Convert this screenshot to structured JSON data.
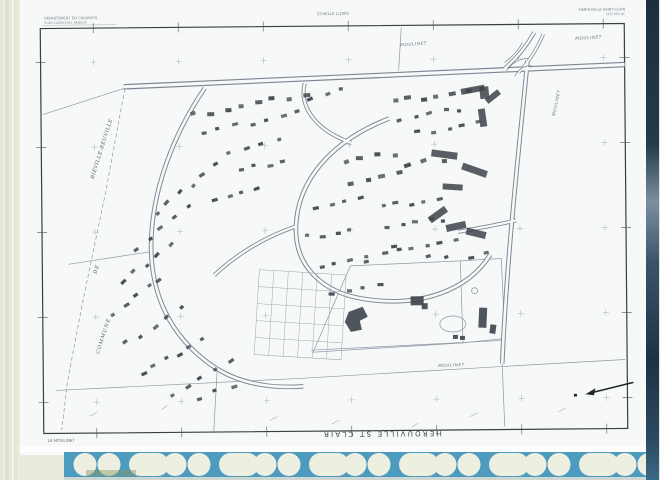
{
  "scan": {
    "film_strip_color": "#4d9cbf",
    "hole_color": "#edf0e1",
    "edge_band_color": "#e9ecdd",
    "paper_color": "#f6f9f8",
    "smudge_color": "#8a9460"
  },
  "header": {
    "left_line1": "DÉPARTEMENT DU CALVADOS",
    "left_line2": "PLAN CADASTRAL RÉNOVÉ",
    "center": "ÉCHELLE 1/2000",
    "right_line1": "HÉROUVILLE SAINT-CLAIR",
    "right_line2": "SECTION AC"
  },
  "labels": {
    "commune_word1": "COMMUNE",
    "commune_word2": "DE",
    "commune_word3": "BIÉVILLE-BEUVILLE",
    "places": [
      {
        "text": "MOULINET",
        "x": 402,
        "y": 47,
        "rot": -4
      },
      {
        "text": "MOULINET",
        "x": 577,
        "y": 42,
        "rot": -3
      },
      {
        "text": "MOULINET",
        "x": 556,
        "y": 118,
        "rot": -78
      },
      {
        "text": "MOULINET",
        "x": 437,
        "y": 368,
        "rot": -2
      }
    ],
    "bottom_title": "HEROUVILLE ST CLAIR",
    "corner_left": "LE MOULINET",
    "corner_right": "C.D.I.F. CAEN"
  },
  "map": {
    "ink": "#3d434b",
    "paper": "#f6f9f8",
    "road_casing": "#7e8594",
    "boundary_color": "#9097a6",
    "frame": {
      "x": 42,
      "y": 26,
      "w": 584,
      "h": 405,
      "rot": -0.5
    },
    "roads": [
      {
        "d": "M125,85 C250,79 420,73 628,67",
        "w": 5.5
      },
      {
        "d": "M529,62 C521,140 507,250 501,365",
        "w": 4.6
      },
      {
        "d": "M206,87 C176,130 150,190 151,250 C152,302 176,342 216,368 C242,384 272,388 302,386",
        "w": 4.6
      },
      {
        "d": "M390,119 C332,141 298,180 296,226 C294,266 322,292 362,299 C420,309 468,291 490,256",
        "w": 4.6
      },
      {
        "d": "M306,83 C300,106 316,130 352,143",
        "w": 4
      },
      {
        "d": "M296,226 C266,236 238,252 214,274",
        "w": 4
      },
      {
        "d": "M458,233 C480,229 500,226 516,222",
        "w": 4
      },
      {
        "d": "M536,34 C528,48 518,60 506,70",
        "w": 4
      },
      {
        "d": "M545,36 C538,52 530,64 520,74",
        "w": 3.4
      }
    ],
    "thin_paths": [
      "M508,72 C514,64 522,60 530,60",
      "M516,78 C520,70 528,66 534,68",
      "M524,44 C520,52 514,58 506,64"
    ],
    "boundaries": [
      {
        "d": "M126,87 L106,190 L82,300 L66,380 L60,428",
        "dash": true
      },
      {
        "d": "M127,86 L44,112"
      },
      {
        "d": "M55,388 L300,378 L500,368 L624,362"
      },
      {
        "d": "M310,350 L500,342"
      },
      {
        "d": "M350,266 L460,262 L462,344 L312,352 Z"
      },
      {
        "d": "M460,262 L501,260 L504,340 L462,344"
      },
      {
        "d": "M400,71 L403,28"
      },
      {
        "d": "M501,365 L503,428"
      },
      {
        "d": "M216,368 L212,430"
      },
      {
        "d": "M151,250 L68,262"
      }
    ],
    "house_strips": [
      [
        196,
        114,
        306,
        94,
        8,
        5
      ],
      [
        204,
        132,
        300,
        112,
        7,
        4
      ],
      [
        312,
        97,
        344,
        89,
        3,
        4
      ],
      [
        395,
        102,
        468,
        93,
        6,
        5
      ],
      [
        400,
        120,
        462,
        110,
        5,
        4
      ],
      [
        420,
        134,
        478,
        124,
        5,
        4
      ],
      [
        157,
        212,
        215,
        163,
        6,
        4
      ],
      [
        137,
        246,
        187,
        207,
        5,
        4
      ],
      [
        121,
        281,
        171,
        243,
        5,
        4
      ],
      [
        112,
        312,
        160,
        277,
        5,
        4
      ],
      [
        126,
        342,
        180,
        307,
        5,
        4
      ],
      [
        142,
        372,
        200,
        338,
        6,
        4
      ],
      [
        172,
        392,
        228,
        362,
        5,
        4
      ],
      [
        196,
        399,
        232,
        384,
        3,
        4
      ],
      [
        316,
        207,
        360,
        200,
        4,
        4
      ],
      [
        309,
        237,
        350,
        230,
        4,
        4
      ],
      [
        321,
        267,
        364,
        260,
        4,
        4
      ],
      [
        332,
        292,
        380,
        286,
        4,
        4
      ],
      [
        382,
        207,
        440,
        200,
        5,
        4
      ],
      [
        387,
        227,
        445,
        220,
        5,
        4
      ],
      [
        396,
        249,
        455,
        242,
        5,
        4
      ],
      [
        346,
        162,
        394,
        154,
        4,
        5
      ],
      [
        352,
        182,
        400,
        174,
        4,
        5
      ],
      [
        406,
        167,
        444,
        160,
        3,
        5
      ],
      [
        366,
        256,
        400,
        251,
        3,
        4
      ],
      [
        430,
        259,
        446,
        256,
        2,
        4
      ],
      [
        470,
        259,
        488,
        255,
        2,
        4
      ],
      [
        230,
        150,
        280,
        140,
        4,
        4
      ],
      [
        240,
        170,
        285,
        160,
        4,
        4
      ],
      [
        215,
        198,
        256,
        190,
        4,
        4
      ]
    ],
    "long_blocks": [
      [
        462,
        88,
        24,
        6,
        -10
      ],
      [
        486,
        95,
        16,
        6,
        -38
      ],
      [
        432,
        152,
        26,
        7,
        8
      ],
      [
        462,
        168,
        26,
        7,
        20
      ],
      [
        443,
        185,
        20,
        6,
        4
      ],
      [
        480,
        110,
        7,
        18,
        -8
      ],
      [
        428,
        212,
        20,
        7,
        -35
      ],
      [
        446,
        224,
        20,
        7,
        -12
      ],
      [
        466,
        231,
        20,
        7,
        14
      ],
      [
        481,
        88,
        9,
        12,
        -5
      ]
    ],
    "solid_rects": [
      [
        410,
        297,
        13,
        9,
        0
      ],
      [
        421,
        304,
        6,
        6,
        0
      ],
      [
        478,
        309,
        8,
        20,
        3
      ],
      [
        489,
        326,
        6,
        9,
        8
      ],
      [
        452,
        336,
        5,
        4,
        0
      ],
      [
        459,
        337,
        5,
        4,
        0
      ]
    ],
    "blob": "M348,312 L362,307 L367,317 L359,321 L361,330 L350,332 L344,322 Z",
    "pond": {
      "cx": 452,
      "cy": 325,
      "rx": 13,
      "ry": 8
    },
    "small_circle": {
      "cx": 474,
      "cy": 292,
      "r": 3
    },
    "allotment": {
      "x": 259,
      "y": 269,
      "cols": 6,
      "rows": 5,
      "cw": 14.5,
      "ch": 17,
      "rot": 4
    },
    "crosses": {
      "x0": 95,
      "y0": 60,
      "dx": 85,
      "dy": 85,
      "nx": 7,
      "ny": 5
    },
    "veg_ticks": [
      [
        88,
        414,
        96,
        410
      ],
      [
        160,
        408,
        166,
        404
      ],
      [
        268,
        420,
        276,
        416
      ],
      [
        330,
        424,
        338,
        420
      ],
      [
        410,
        428,
        416,
        424
      ],
      [
        468,
        418,
        476,
        414
      ],
      [
        556,
        414,
        564,
        410
      ]
    ],
    "north_arrow": {
      "tail": [
        632,
        385
      ],
      "head": [
        586,
        396
      ]
    }
  }
}
